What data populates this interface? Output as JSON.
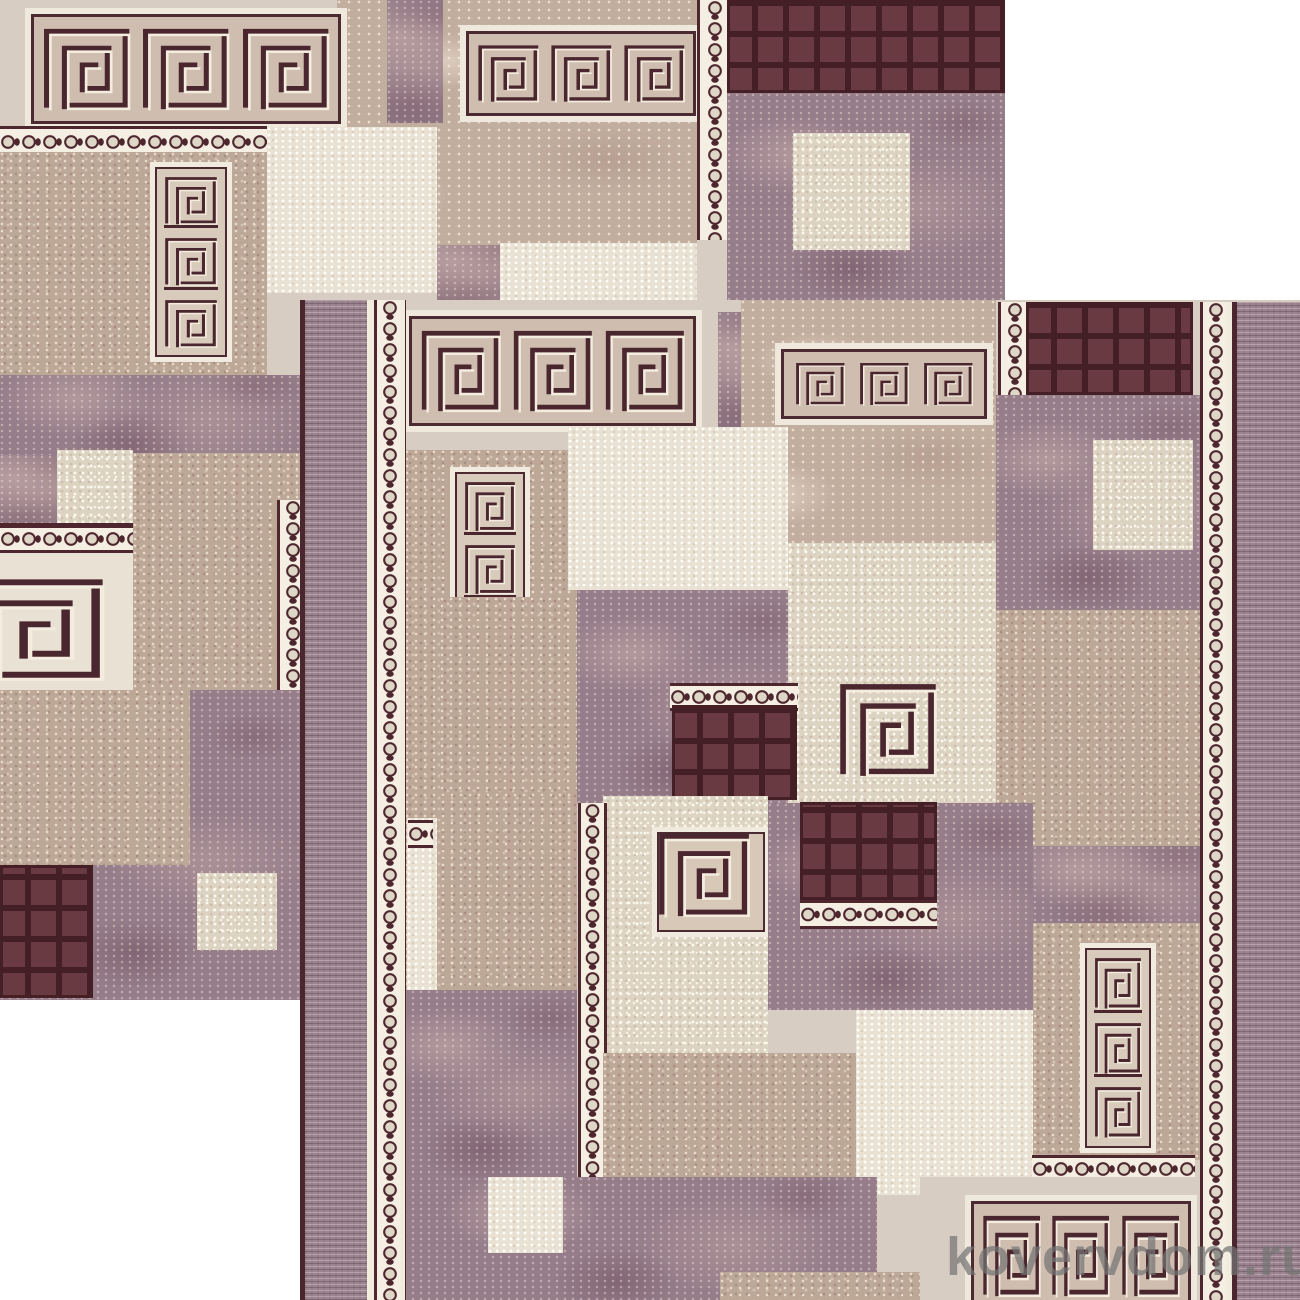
{
  "image": {
    "description": "Product photo of a beige-mauve geometric runner carpet with Greek-key meander motifs, pearl-bead borders and chocolate grid squares, displayed as two overlapping diagonal tiles on a white background",
    "width": 1300,
    "height": 1300,
    "background": "#ffffff"
  },
  "watermark": {
    "text": "kovervdom.ru",
    "color": "rgba(116,116,116,0.72)"
  },
  "palette": {
    "dark_outline": "#4a262e",
    "cream_line": "#f3ecdf",
    "bead_background": "#f4eee3",
    "grid_cell": "#693a41",
    "grid_line": "#451f26",
    "plain_beige": "#d7cdc2",
    "tan_speckle": "#bda797",
    "tan_marble": "#c2ae9f",
    "cream_speckle": "#ddd3c2",
    "light_speckle": "#e9e1d3",
    "mauve_marble": "#967d8a",
    "border_stripe": "#9c8590",
    "white": "#f2ecdf"
  },
  "carpet": {
    "copies": [
      {
        "name": "carpet-tile-back",
        "x": 0,
        "y": 0,
        "w": 1005,
        "h": 1000,
        "blocks": [
          [
            "rect",
            "plain",
            0,
            0,
            1005,
            1000
          ],
          [
            "rect",
            "marble",
            337,
            0,
            360,
            245
          ],
          [
            "rect",
            "purple",
            387,
            0,
            56,
            123
          ],
          [
            "band",
            3,
            25,
            8,
            310,
            110
          ],
          [
            "band",
            3,
            460,
            25,
            230,
            85
          ],
          [
            "beadv",
            697,
            0,
            30,
            240
          ],
          [
            "grid",
            727,
            0,
            278,
            93
          ],
          [
            "rect",
            "purple",
            727,
            93,
            278,
            207
          ],
          [
            "rect",
            "cream",
            793,
            133,
            117,
            117
          ],
          [
            "beadh",
            0,
            126,
            267,
            26
          ],
          [
            "rect",
            "tan",
            0,
            152,
            267,
            223
          ],
          [
            "panel3",
            150,
            162,
            72,
            190
          ],
          [
            "rect",
            "cream2",
            267,
            127,
            170,
            166
          ],
          [
            "rect",
            "purple",
            437,
            245,
            63,
            55
          ],
          [
            "rect",
            "cream2",
            500,
            243,
            197,
            57
          ],
          [
            "rect",
            "purple",
            0,
            375,
            300,
            80
          ],
          [
            "rect",
            "purple",
            0,
            455,
            57,
            72
          ],
          [
            "rect",
            "cream",
            57,
            450,
            76,
            75
          ],
          [
            "rect",
            "tan",
            133,
            453,
            170,
            237
          ],
          [
            "panelcut",
            0,
            523,
            133,
            179
          ],
          [
            "beadv",
            277,
            500,
            26,
            435
          ],
          [
            "rect",
            "purple",
            0,
            690,
            300,
            310
          ],
          [
            "rect",
            "tan",
            0,
            690,
            190,
            175
          ],
          [
            "grid",
            0,
            865,
            93,
            133
          ],
          [
            "rect",
            "cream",
            197,
            873,
            80,
            77
          ]
        ]
      },
      {
        "name": "carpet-tile-front",
        "x": 300,
        "y": 300,
        "w": 1000,
        "h": 1000,
        "blocks": [
          [
            "rect",
            "plain",
            0,
            0,
            1000,
            1000
          ],
          [
            "band",
            3,
            103,
            10,
            287,
            110
          ],
          [
            "rect",
            "purple",
            418,
            12,
            57,
            118
          ],
          [
            "rect",
            "marble",
            441,
            0,
            255,
            243
          ],
          [
            "band",
            3,
            475,
            43,
            206,
            70
          ],
          [
            "beadv",
            698,
            2,
            28,
            245
          ],
          [
            "grid",
            726,
            2,
            167,
            93
          ],
          [
            "rect",
            "purple",
            696,
            95,
            206,
            215
          ],
          [
            "rect",
            "cream",
            793,
            140,
            100,
            110
          ],
          [
            "rect",
            "tan",
            696,
            310,
            206,
            313
          ],
          [
            "rect",
            "tan",
            105,
            150,
            172,
            540
          ],
          [
            "panel3",
            150,
            167,
            70,
            195
          ],
          [
            "rect",
            "cream2",
            268,
            127,
            220,
            163
          ],
          [
            "rect",
            "tan",
            140,
            297,
            137,
            196
          ],
          [
            "rect",
            "purple",
            277,
            290,
            220,
            213
          ],
          [
            "rect",
            "cream",
            488,
            243,
            208,
            260
          ],
          [
            "spiral",
            0,
            538,
            382,
            100,
            96
          ],
          [
            "beadh",
            370,
            383,
            128,
            22
          ],
          [
            "grid",
            372,
            405,
            125,
            95
          ],
          [
            "rect",
            "cream2",
            107,
            518,
            30,
            214
          ],
          [
            "beadh",
            108,
            520,
            25,
            22
          ],
          [
            "rect",
            "purple",
            103,
            690,
            174,
            187
          ],
          [
            "rect",
            "cream",
            303,
            496,
            165,
            257
          ],
          [
            "spiral",
            1,
            352,
            527,
            108,
            100
          ],
          [
            "rect",
            "purple",
            468,
            503,
            265,
            207
          ],
          [
            "grid",
            500,
            502,
            137,
            98
          ],
          [
            "beadh",
            500,
            600,
            137,
            23
          ],
          [
            "beadv",
            278,
            503,
            23,
            374
          ],
          [
            "rect",
            "purple",
            733,
            546,
            169,
            77
          ],
          [
            "rect",
            "tan",
            733,
            623,
            169,
            237
          ],
          [
            "panel3",
            780,
            643,
            66,
            200
          ],
          [
            "rect",
            "tan",
            303,
            753,
            253,
            124
          ],
          [
            "rect",
            "cream2",
            556,
            710,
            177,
            185
          ],
          [
            "beadh",
            732,
            855,
            163,
            22
          ],
          [
            "rect",
            "purple",
            103,
            877,
            474,
            123
          ],
          [
            "rect",
            "cream2",
            188,
            877,
            75,
            76
          ],
          [
            "rect",
            "plain",
            620,
            877,
            282,
            123
          ],
          [
            "rect",
            "tan",
            420,
            972,
            200,
            28
          ],
          [
            "band",
            3,
            665,
            895,
            220,
            110
          ],
          [
            "fill",
            "dark_outline",
            0,
            0,
            5,
            1000
          ],
          [
            "rect",
            "striate",
            5,
            0,
            62,
            1000
          ],
          [
            "fill",
            "white",
            67,
            0,
            7,
            1000
          ],
          [
            "beadv",
            74,
            0,
            26,
            1000
          ],
          [
            "fill",
            "white",
            100,
            0,
            5,
            1000
          ],
          [
            "beadv",
            900,
            2,
            26,
            998
          ],
          [
            "fill",
            "white",
            926,
            2,
            6,
            998
          ],
          [
            "fill",
            "dark_outline",
            932,
            2,
            5,
            998
          ],
          [
            "rect",
            "striate",
            937,
            2,
            63,
            998
          ]
        ]
      }
    ]
  }
}
